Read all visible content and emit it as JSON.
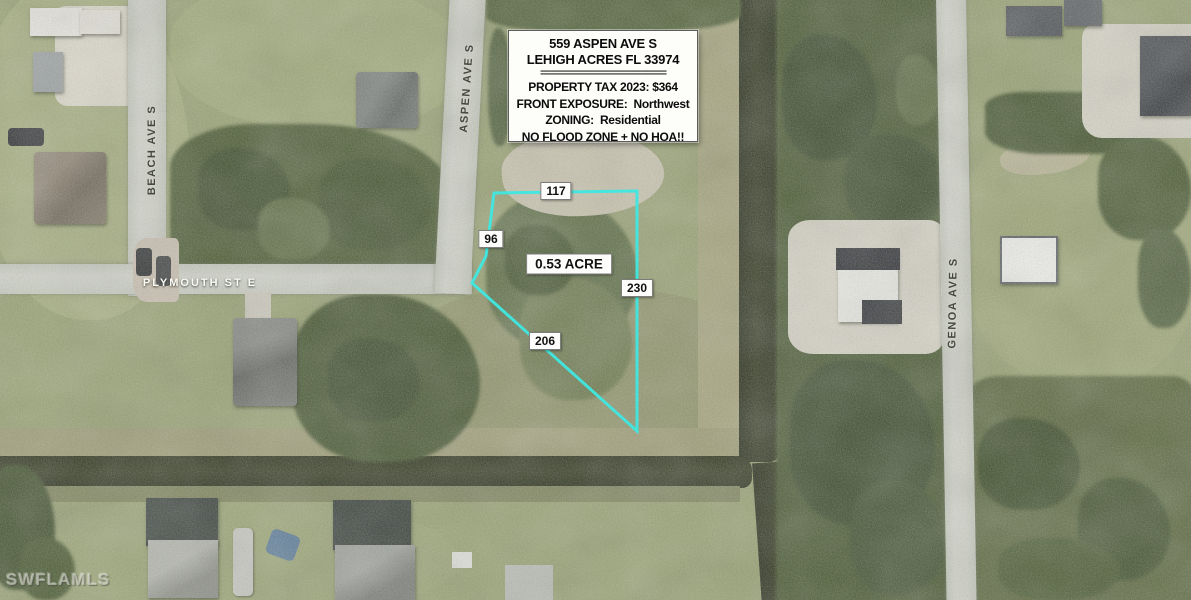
{
  "map": {
    "info_box": {
      "address": "559 ASPEN AVE S",
      "city": "LEHIGH ACRES FL 33974",
      "divider": "==========================",
      "tax": "PROPERTY TAX 2023: $364",
      "exposure": "FRONT EXPOSURE:  Northwest",
      "zoning": "ZONING:  Residential",
      "flood": "NO FLOOD ZONE + NO HOA!!"
    },
    "lot": {
      "dim_top": "117",
      "dim_left": "96",
      "dim_right": "230",
      "dim_diagonal": "206",
      "area": "0.53 ACRE",
      "outline_color": "#3fe8e2"
    },
    "streets": {
      "beach": "BEACH AVE S",
      "aspen": "ASPEN AVE S",
      "plymouth": "PLYMOUTH ST E",
      "genoa": "GENOA AVE S"
    },
    "watermark": "SWFLAMLS"
  }
}
